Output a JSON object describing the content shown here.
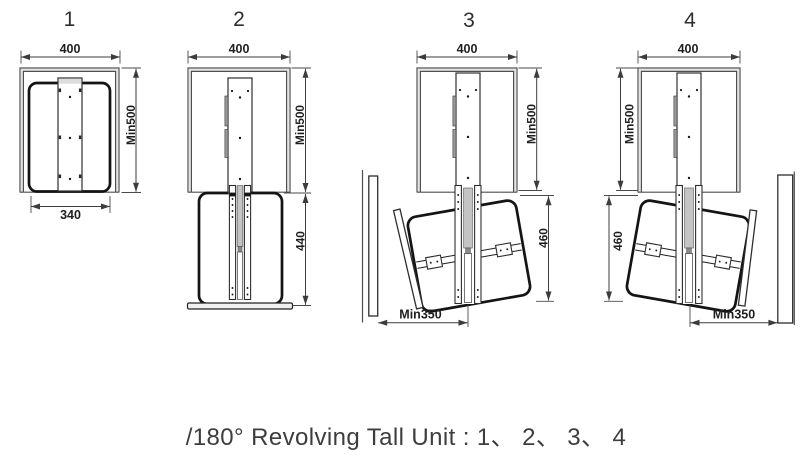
{
  "caption": "/180° Revolving Tall Unit : 1、 2、 3、 4",
  "panels": [
    {
      "number": "1",
      "dim_top_width": "400",
      "dim_cabinet_height": "Min500",
      "dim_basket_width": "340"
    },
    {
      "number": "2",
      "dim_top_width": "400",
      "dim_cabinet_height": "Min500",
      "dim_pulldown_height": "440"
    },
    {
      "number": "3",
      "dim_top_width": "400",
      "dim_cabinet_height": "Min500",
      "dim_pulldown_height": "460",
      "dim_clearance": "Min350"
    },
    {
      "number": "4",
      "dim_top_width": "400",
      "dim_cabinet_height": "Min500",
      "dim_pulldown_height": "460",
      "dim_clearance": "Min350"
    }
  ],
  "colors": {
    "line": "#4f4f4f",
    "thick_line": "#141414",
    "dim_line": "#3c3c3c",
    "dim_text": "#1f1f1f",
    "caption_text": "#3d3d3d",
    "gray_fill": "#9b9b9b",
    "rail_gray": "#c4c4c4",
    "light_gray": "#e4e4e4",
    "background": "#ffffff"
  }
}
